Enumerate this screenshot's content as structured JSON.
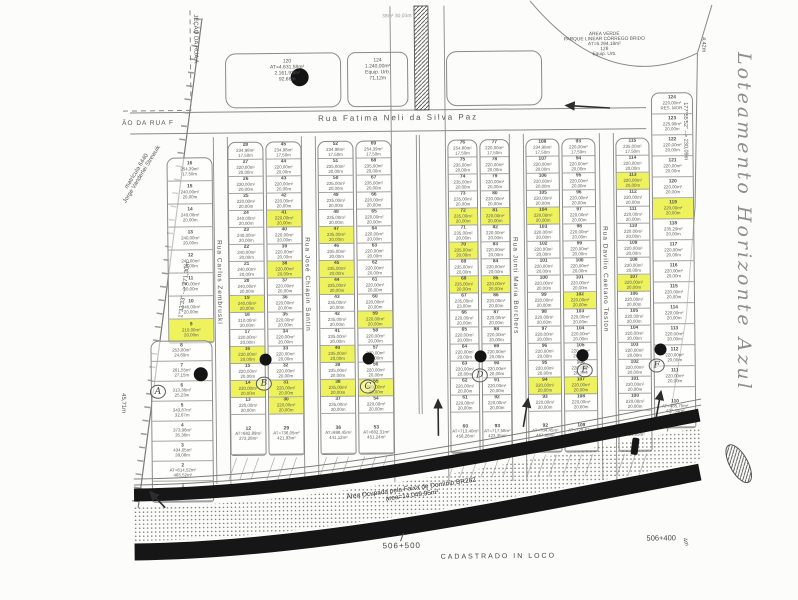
{
  "document": {
    "handwritten_title": "Loteamento  Horizonte  Azul",
    "bottom_note": "CADASTRADO  IN  LOCO"
  },
  "colors": {
    "highlight": "#eef25c",
    "line": "#8a8a8a",
    "ink": "#555555",
    "road": "#161616",
    "paper": "#fcfcfa",
    "pencil": "#8e8e8e"
  },
  "map": {
    "defaults": {
      "area": "220,00m²",
      "width": "20,00m"
    },
    "streets": {
      "top": "Rua Fatima Neli da Silva Paz",
      "vertical": [
        "Rua Carlos Zembruski",
        "Rua José Chiapin Santin",
        "Rua Junti Maria Borchers",
        "Rua Davilio Caetano Teston"
      ]
    },
    "strips": [
      {
        "id": "A-upper",
        "x": 168,
        "y": 155,
        "w": 46,
        "rh": 23,
        "lots": [
          [
            16,
            "254,39m²",
            "17,50m"
          ],
          [
            15,
            "240,00m²",
            null
          ],
          [
            14,
            "240,00m²",
            null
          ],
          [
            13,
            "240,00m²",
            null
          ],
          [
            12,
            "240,00m²",
            null
          ],
          [
            11,
            "240,00m²",
            null
          ],
          [
            10,
            "246,00m²",
            null
          ],
          [
            9,
            "210,00m²",
            null,
            "h"
          ]
        ]
      },
      {
        "id": "A-lower",
        "x": 150,
        "y": 338,
        "w": 62,
        "rh": 20,
        "lots": [
          [
            8,
            "253,00m²",
            "24,60m"
          ],
          [
            7,
            "261,55m²",
            "27,15m"
          ],
          [
            6,
            "313,36m²",
            "25,23m"
          ],
          [
            5,
            "343,87m²",
            "32,67m"
          ],
          [
            4,
            "373,96m²",
            "35,36m"
          ],
          [
            3,
            "434,05m²",
            "39,08m"
          ],
          [
            2,
            "AT=614,52m²",
            "465,52m²"
          ],
          [
            1,
            "AT=1.301,49m²",
            "605,88m²"
          ]
        ]
      },
      {
        "id": "B-left",
        "x": 229,
        "lots": [
          [
            28,
            "234,98m²",
            "17,50m"
          ],
          [
            27
          ],
          [
            26
          ],
          [
            25
          ],
          [
            24,
            "240,00m²"
          ],
          [
            23,
            "240,00m²"
          ],
          [
            22,
            "240,00m²"
          ],
          [
            21,
            "240,00m²"
          ],
          [
            20,
            "240,00m²"
          ],
          [
            19,
            "240,00m²",
            null,
            "h"
          ],
          [
            18,
            "210,00m²"
          ],
          [
            17
          ],
          [
            16,
            null,
            null,
            "h"
          ],
          [
            15
          ],
          [
            14,
            null,
            null,
            "h"
          ],
          [
            13
          ]
        ],
        "big": [
          12,
          "AT=682,89m²",
          "273,28m²"
        ]
      },
      {
        "id": "B-right",
        "x": 267,
        "lots": [
          [
            45,
            "234,98m²",
            "17,50m"
          ],
          [
            44
          ],
          [
            43
          ],
          [
            42
          ],
          [
            41,
            null,
            null,
            "h"
          ],
          [
            40
          ],
          [
            39
          ],
          [
            38,
            null,
            null,
            "h"
          ],
          [
            37
          ],
          [
            36
          ],
          [
            35
          ],
          [
            34
          ],
          [
            33
          ],
          [
            32
          ],
          [
            31,
            null,
            null,
            "h"
          ],
          [
            30,
            null,
            null,
            "h"
          ]
        ],
        "big": [
          29,
          "AT=736,05m²",
          "421,93m²"
        ]
      },
      {
        "id": "C-left",
        "x": 319,
        "lots": [
          [
            52,
            "234,98m²",
            "17,50m"
          ],
          [
            51,
            "235,00m²"
          ],
          [
            50,
            "235,00m²"
          ],
          [
            49,
            "235,00m²"
          ],
          [
            48,
            "235,00m²"
          ],
          [
            47,
            "235,00m²",
            null,
            "h"
          ],
          [
            46,
            "235,00m²"
          ],
          [
            45,
            "235,00m²",
            null,
            "h"
          ],
          [
            44,
            "235,00m²",
            null,
            "h"
          ],
          [
            43,
            "235,00m²"
          ],
          [
            42,
            "235,00m²"
          ],
          [
            41,
            "235,00m²"
          ],
          [
            40,
            "235,00m²",
            null,
            "h"
          ],
          [
            39,
            "235,00m²"
          ],
          [
            38,
            "235,00m²",
            null,
            "h"
          ],
          [
            37,
            "235,00m²"
          ]
        ],
        "big": [
          36,
          "AT=698,45m²",
          "441,12m²"
        ]
      },
      {
        "id": "C-right",
        "x": 357,
        "lots": [
          [
            69,
            "254,39m²",
            "17,50m"
          ],
          [
            68,
            "235,00m²"
          ],
          [
            67,
            "235,00m²"
          ],
          [
            66
          ],
          [
            65
          ],
          [
            64
          ],
          [
            63
          ],
          [
            62
          ],
          [
            61
          ],
          [
            60
          ],
          [
            59,
            null,
            null,
            "h"
          ],
          [
            58
          ],
          [
            57
          ],
          [
            56
          ],
          [
            55,
            null,
            null,
            "h"
          ],
          [
            54
          ]
        ],
        "big": [
          53,
          "AT=682,31m²",
          "451,24m²"
        ]
      },
      {
        "id": "D-left",
        "x": 449,
        "w": 30,
        "lots": [
          [
            76,
            "254,80m²",
            "17,50m"
          ],
          [
            75,
            "235,00m²"
          ],
          [
            74,
            "235,00m²"
          ],
          [
            73,
            "235,00m²"
          ],
          [
            72,
            "235,00m²",
            null,
            "h"
          ],
          [
            71,
            "235,00m²"
          ],
          [
            70,
            "235,00m²",
            null,
            "h"
          ],
          [
            69,
            "235,00m²"
          ],
          [
            68,
            "235,00m²",
            null,
            "h"
          ],
          [
            67,
            "235,00m²",
            "23,00m"
          ],
          [
            66
          ],
          [
            65
          ],
          [
            64
          ],
          [
            63
          ],
          [
            62
          ],
          [
            61
          ]
        ],
        "big": [
          60,
          "AT=713,40m²",
          "456,26m²"
        ]
      },
      {
        "id": "D-right",
        "x": 481,
        "w": 30,
        "lots": [
          [
            77,
            "220,00m²",
            "17,50m"
          ],
          [
            78
          ],
          [
            79
          ],
          [
            80
          ],
          [
            81,
            null,
            null,
            "h"
          ],
          [
            82
          ],
          [
            83
          ],
          [
            84
          ],
          [
            85,
            null,
            null,
            "h"
          ],
          [
            86
          ],
          [
            87
          ],
          [
            88
          ],
          [
            89
          ],
          [
            90
          ],
          [
            91
          ],
          [
            92
          ]
        ],
        "big": [
          93,
          "AT=717,58m²",
          "423,35m²"
        ]
      },
      {
        "id": "E-left",
        "x": 527,
        "w": 34,
        "lots": [
          [
            108,
            "234,98m²",
            "17,50m"
          ],
          [
            107
          ],
          [
            106
          ],
          [
            105
          ],
          [
            104,
            null,
            null,
            "h"
          ],
          [
            103
          ],
          [
            102
          ],
          [
            101
          ],
          [
            100
          ],
          [
            99
          ],
          [
            98
          ],
          [
            97
          ],
          [
            96
          ],
          [
            95
          ],
          [
            94,
            null,
            null,
            "h"
          ],
          [
            93
          ]
        ],
        "big": [
          92,
          "AT=704,45m²",
          "467,88m²"
        ]
      },
      {
        "id": "E-right",
        "x": 563,
        "w": 34,
        "lots": [
          [
            93,
            "220,00m²",
            "17,50m"
          ],
          [
            94
          ],
          [
            95
          ],
          [
            96
          ],
          [
            97
          ],
          [
            98
          ],
          [
            99
          ],
          [
            100
          ],
          [
            101
          ],
          [
            102,
            null,
            null,
            "h"
          ],
          [
            103
          ],
          [
            104
          ],
          [
            105
          ],
          [
            106
          ],
          [
            107,
            null,
            null,
            "h"
          ],
          [
            108
          ]
        ],
        "big": [
          109,
          "AT=729,62m²",
          "447,15m²"
        ]
      },
      {
        "id": "F-left",
        "x": 617,
        "w": 34,
        "lots": [
          [
            115,
            "235,00m²",
            "17,50m"
          ],
          [
            114
          ],
          [
            113,
            null,
            null,
            "h"
          ],
          [
            112
          ],
          [
            111
          ],
          [
            110
          ],
          [
            109
          ],
          [
            108
          ],
          [
            107,
            null,
            null,
            "h"
          ],
          [
            106
          ],
          [
            105
          ],
          [
            104
          ],
          [
            103
          ],
          [
            102
          ],
          [
            101
          ],
          [
            100
          ]
        ],
        "big": [
          111,
          "AT=720,96m²",
          "429,85m²"
        ]
      },
      {
        "id": "F-right",
        "x": 653,
        "y": 95,
        "w": 42,
        "rh": 21,
        "lots": [
          [
            124,
            "220,00m²",
            "RES. MOR."
          ],
          [
            123,
            "225,90m²"
          ],
          [
            122
          ],
          [
            121
          ],
          [
            120
          ],
          [
            119,
            null,
            null,
            "h"
          ],
          [
            118,
            "235,29m²"
          ],
          [
            117
          ],
          [
            116
          ],
          [
            115
          ],
          [
            114
          ],
          [
            113
          ],
          [
            112
          ],
          [
            111
          ]
        ],
        "big": [
          110,
          "AT=485,75m²",
          "427,34m²"
        ]
      }
    ],
    "blockMarkers": [
      [
        "A",
        157,
        389
      ],
      [
        "B",
        263,
        382
      ],
      [
        "C",
        367,
        386
      ],
      [
        "D",
        479,
        376
      ],
      [
        "E",
        584,
        372
      ],
      [
        "F",
        656,
        368
      ]
    ],
    "dots": [
      [
        302,
        76,
        9
      ],
      [
        265,
        358,
        6
      ],
      [
        368,
        358,
        6
      ],
      [
        480,
        357,
        6
      ],
      [
        582,
        357,
        6
      ],
      [
        660,
        352,
        6
      ],
      [
        200,
        372,
        7
      ]
    ],
    "arrows": [
      [
        612,
        110,
        568,
        107
      ],
      [
        437,
        436,
        437,
        400
      ],
      [
        522,
        428,
        527,
        400
      ],
      [
        655,
        420,
        660,
        394
      ],
      [
        163,
        505,
        148,
        489
      ]
    ],
    "annotations": [
      {
        "id": "street-fatima-label",
        "t": "Rua Fatima Neli da Silva Paz",
        "x": 320,
        "y": 113,
        "s": 8,
        "ls": 2
      },
      {
        "id": "rua-f-label",
        "t": "ÃO DA RUA F",
        "x": 124,
        "y": 117,
        "s": 6.5,
        "ls": 1
      },
      {
        "id": "secao-rua-a-label",
        "t": "JEÇÃO DA RUA A",
        "x": 195,
        "y": 12,
        "s": 6,
        "v": 1
      },
      {
        "id": "matricula-label",
        "t": "matrícula 6440\nJorge Vanderlei Strewuik",
        "x": 112,
        "y": 205,
        "s": 6,
        "r": -58,
        "w": 90,
        "ctr": 1
      },
      {
        "id": "medida-oeste",
        "t": "1°33'33\" --> 271,30m",
        "x": 178,
        "y": 315,
        "s": 6,
        "r": -82,
        "w": 120
      },
      {
        "id": "medida-45m",
        "t": "45,71m",
        "x": 119,
        "y": 390,
        "s": 6,
        "v": 1
      },
      {
        "id": "lote-120-label",
        "t": "120\nAT=4.631,58m²\n2.161,93m²\n92,68m",
        "x": 252,
        "y": 57,
        "s": 5,
        "w": 75,
        "ctr": 1
      },
      {
        "id": "lote-124-label",
        "t": "124\n1.240,00m²\nEquip. Urb.\n71,12m",
        "x": 352,
        "y": 57,
        "s": 5,
        "w": 56,
        "ctr": 1
      },
      {
        "id": "area-verde-label",
        "t": "ÁREA VERDE\nPARQUE LINEAR CÓRREGO BRIDO\nAT=6.294,18m²\n128\nEquip. Urb.",
        "x": 553,
        "y": 34,
        "s": 4.8,
        "w": 108,
        "ctr": 1
      },
      {
        "id": "medida-ne",
        "t": "4,42m",
        "x": 703,
        "y": 40,
        "s": 5.5,
        "v": 1
      },
      {
        "id": "medida-leste",
        "t": "177°55'52\" --> 230,09m",
        "x": 684,
        "y": 105,
        "s": 5.5,
        "v": 1
      },
      {
        "id": "km-506-500",
        "t": "506+500",
        "x": 380,
        "y": 541,
        "s": 8,
        "ls": 1,
        "c": "#444"
      },
      {
        "id": "cadastrado-label",
        "t": "CADASTRADO  IN  LOCO",
        "x": 438,
        "y": 554,
        "s": 7,
        "ls": 2,
        "c": "#444"
      },
      {
        "id": "km-506-400",
        "t": "506+400",
        "x": 644,
        "y": 536,
        "s": 7.5,
        "c": "#444"
      },
      {
        "id": "medida-4m",
        "t": "4m",
        "x": 684,
        "y": 540,
        "s": 6,
        "r": 70
      },
      {
        "id": "faixa-dominio-label",
        "t": "Área Ocupada pela Faixa de Domínio BR282\nárea=14.049,95m²",
        "x": 312,
        "y": 497,
        "s": 6.5,
        "r": -7,
        "w": 195,
        "ctr": 1,
        "c": "#333"
      },
      {
        "id": "cota-top",
        "t": "38m²   30,03m",
        "x": 385,
        "y": 13,
        "s": 5,
        "c": "#999"
      },
      {
        "id": "street-zembruski-label",
        "t": "Rua Carlos Zembruski",
        "x": 216,
        "y": 238,
        "s": 6.5,
        "v": 1,
        "ls": 1
      },
      {
        "id": "street-chiapin-label",
        "t": "Rua José Chiapin Santin",
        "x": 304,
        "y": 236,
        "s": 6.5,
        "v": 1,
        "ls": 1
      },
      {
        "id": "street-borchers-label",
        "t": "Rua Junti Maria Borchers",
        "x": 512,
        "y": 238,
        "s": 6.5,
        "v": 1,
        "ls": 1
      },
      {
        "id": "street-teston-label",
        "t": "Rua Davilio Caetano Teston",
        "x": 602,
        "y": 228,
        "s": 6.5,
        "v": 1,
        "ls": 1
      }
    ],
    "handwriting": {
      "id": "handwriting-title",
      "x": 733,
      "y": 52,
      "s": 19
    }
  }
}
